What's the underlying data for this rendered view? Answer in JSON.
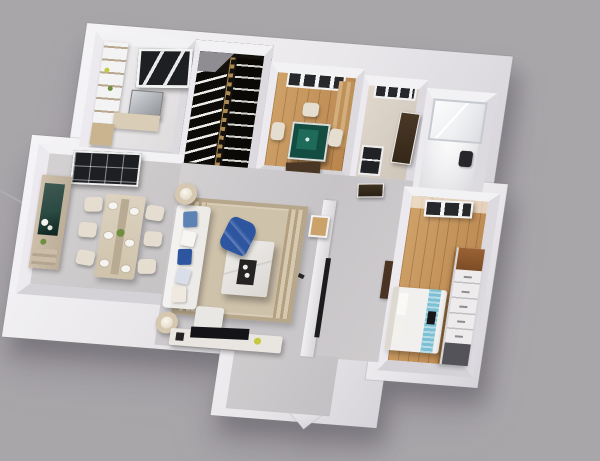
{
  "image_type": "3d-apartment-floorplan-render",
  "description": "Isometric 3D dollhouse render of an apartment with white walls on a plain gray background, rotated slightly clockwise",
  "palette": {
    "bg": "#a9a6aa",
    "wall_hi": "#f5f4f6",
    "wall": "#e9e7ea",
    "wall_dark": "#d6d4d9",
    "floor_gray": "#cac7c9",
    "wood": "#b9854e",
    "wood_light": "#cfa269",
    "stair": "#15110c",
    "brass": "#ad8b52",
    "green_table": "#134c41",
    "green_table_light": "#1e6b5a",
    "window_dark": "#1d1f23",
    "door_brown": "#4a3624",
    "beige": "#d9cdb8",
    "chair_cream": "#e4ddd0",
    "sofa_white": "#edebe8",
    "blue_dark": "#2d55a0",
    "blue_mid": "#5d83b5",
    "blue_runner": "#7cc0d4",
    "marble": "#ece9e6",
    "tray_dark": "#262422",
    "tv_black": "#141317",
    "plant_green": "#6f8f3f",
    "accent_yellow": "#c5c93e",
    "mirror_teal": "#2a4a42"
  },
  "scene": {
    "rooms": [
      {
        "id": "kitchen",
        "name": "kitchen",
        "floor": "light-gray",
        "items": [
          "shelf-unit",
          "dark-framed-window",
          "steel-appliance",
          "wood-counter"
        ]
      },
      {
        "id": "staircase",
        "name": "staircase",
        "floor": "black",
        "items": [
          "left-flight-white-steps",
          "right-flight",
          "brass-railing",
          "gray-landing"
        ]
      },
      {
        "id": "mahjong-room",
        "name": "mahjong room",
        "floor": "wood",
        "items": [
          "window",
          "green-mahjong-table",
          "three-cream-chairs",
          "wood-wall-panel",
          "brown-door-mat"
        ]
      },
      {
        "id": "corridor-room",
        "name": "corridor room",
        "floor": "warm-beige",
        "items": [
          "window",
          "leaning-brown-door",
          "small-dark-window"
        ]
      },
      {
        "id": "bathroom",
        "name": "bathroom",
        "floor": "bright-white",
        "items": [
          "glass-shower",
          "dark-toilet"
        ]
      },
      {
        "id": "dining-room",
        "name": "dining room",
        "floor": "gray",
        "items": [
          "dark-lattice-window",
          "sideboard-with-teal-mirror",
          "white-flowers",
          "dining-table",
          "six-cream-chairs",
          "plates"
        ]
      },
      {
        "id": "living-room",
        "name": "living room",
        "floor": "gray-concrete",
        "items": [
          "striped-border-rug",
          "white-sofa-with-blue-pillows",
          "marble-coffee-table",
          "dark-tray",
          "blue-throw",
          "two-drum-lamp-side-tables",
          "tv-console",
          "flat-black-tv",
          "yellow-plant"
        ]
      },
      {
        "id": "hallway",
        "name": "hallway",
        "floor": "gray-concrete",
        "items": [
          "wall-mounted-tv-bar",
          "picture-frame",
          "two-dark-doors",
          "entry-door-notch",
          "dark-cabinet"
        ]
      },
      {
        "id": "bedroom",
        "name": "bedroom",
        "floor": "wood",
        "items": [
          "window",
          "white-bed",
          "light-blue-textured-runner",
          "dark-object-on-bed",
          "white-wardrobe-dresser",
          "wood-top-panel",
          "dark-mirror-panel"
        ]
      }
    ],
    "background": {
      "color_name": "plain gray",
      "details": [
        "faint diagonal scratch line lower-left",
        "soft shadow under apartment walls"
      ]
    }
  }
}
